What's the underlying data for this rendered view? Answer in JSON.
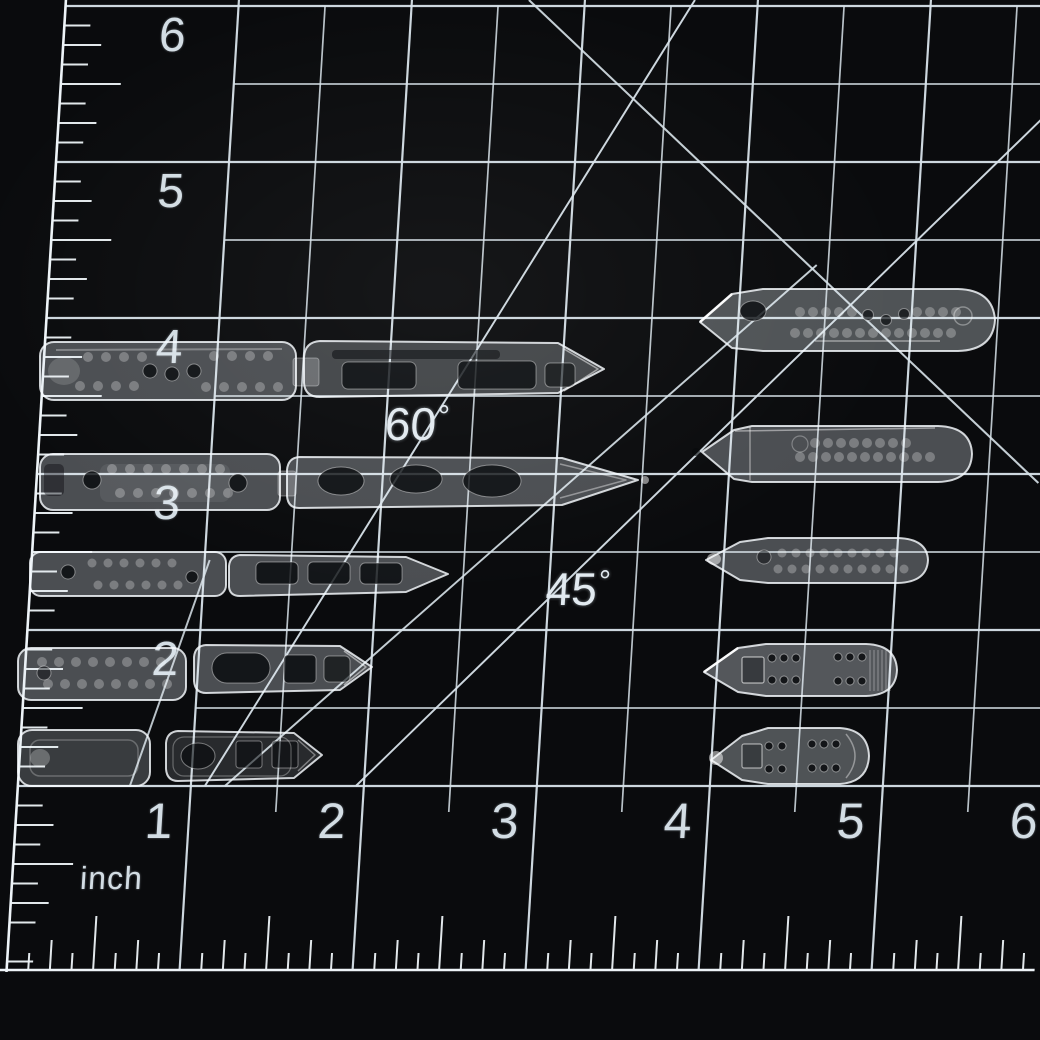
{
  "scene": {
    "description": "clear translucent miniature ship model parts arranged in two columns on a black self-healing cutting mat with white inch grid"
  },
  "mat": {
    "background_color": "#0a0b0d",
    "grid_color": "#d8e3ea",
    "ruler_color": "#eef4f8",
    "number_color": "#d3dde4",
    "unit_label": "inch",
    "left_axis_labels": [
      "6",
      "5",
      "4",
      "3",
      "2"
    ],
    "bottom_axis_labels": [
      "1",
      "2",
      "3",
      "4",
      "5",
      "6"
    ],
    "angle_labels": [
      {
        "value": "60",
        "degree_symbol": "°"
      },
      {
        "value": "45",
        "degree_symbol": "°"
      }
    ]
  },
  "parts": {
    "material_color": "rgba(228,235,242,0.30)",
    "edge_color": "rgba(248,251,255,0.82)",
    "hole_color": "rgba(4,6,9,0.78)",
    "porthole_color": "rgba(255,255,255,0.27)",
    "left_column_names": [
      "ship-hull-half-row1",
      "ship-deck-row1",
      "ship-hull-half-row2",
      "ship-deck-row2",
      "ship-hull-half-row3",
      "ship-deck-row3",
      "ship-hull-half-row4",
      "ship-deck-row4",
      "ship-hull-half-row5",
      "ship-deck-row5"
    ],
    "right_column_names": [
      "ship-hull-row1",
      "ship-hull-row2",
      "ship-hull-row3",
      "ship-hull-row4",
      "ship-hull-row5"
    ]
  }
}
